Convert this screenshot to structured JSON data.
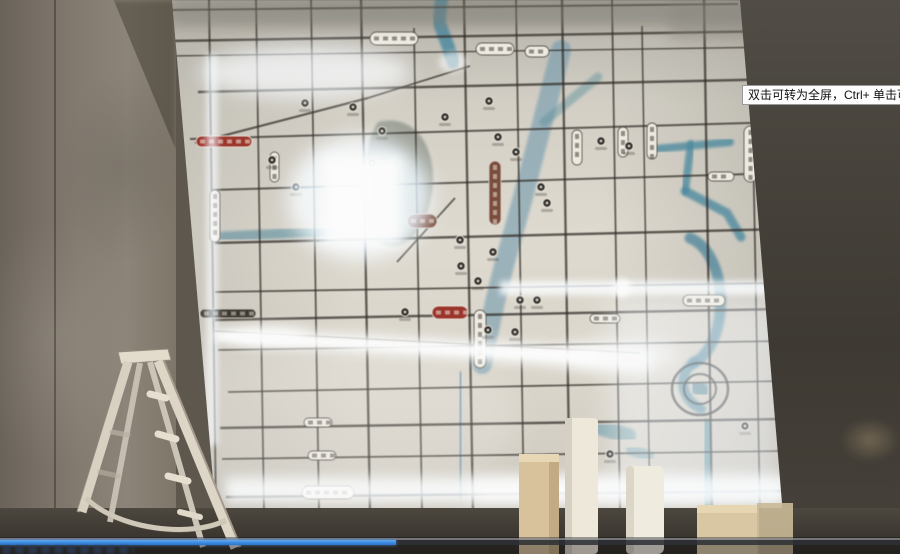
{
  "player": {
    "tooltip": "双击可转为全屏，Ctrl+ 单击可转为",
    "progress_percent": 44,
    "colors": {
      "progress": "#3f8fe6",
      "track": "#2e3036"
    }
  },
  "map": {
    "colors": {
      "road": "#2f2a24"
    },
    "label_styles": {
      "w": {
        "f": "#efece3",
        "s": "rgba(62,56,47,0.8)",
        "t": "#443e34"
      },
      "r": {
        "f": "#a33228",
        "s": "#e9e1d3",
        "t": "#f5ece0"
      },
      "rb": {
        "f": "#7d4a38",
        "s": "#d8d0c2",
        "t": "#efe5d8"
      },
      "d": {
        "f": "#3c372f",
        "s": "#cfc8ba",
        "t": "#d6cfc0"
      }
    },
    "roads": [
      [
        0,
        10,
        568,
        4,
        2
      ],
      [
        0,
        41,
        610,
        31,
        2.5
      ],
      [
        0,
        56,
        610,
        47,
        1.5
      ],
      [
        28,
        92,
        613,
        79,
        2.5
      ],
      [
        20,
        139,
        613,
        122,
        2
      ],
      [
        42,
        190,
        613,
        173,
        2
      ],
      [
        45,
        243,
        613,
        229,
        2.5
      ],
      [
        45,
        292,
        613,
        283,
        1.8
      ],
      [
        45,
        320,
        613,
        309,
        2.5
      ],
      [
        48,
        350,
        613,
        341,
        1.8
      ],
      [
        58,
        392,
        613,
        381,
        1.8
      ],
      [
        50,
        428,
        613,
        419,
        2.5
      ],
      [
        52,
        459,
        613,
        451,
        1.8
      ],
      [
        56,
        497,
        613,
        491,
        2.5
      ],
      [
        39,
        0,
        46,
        512,
        2
      ],
      [
        86,
        0,
        94,
        512,
        1.8
      ],
      [
        141,
        0,
        149,
        512,
        1.8
      ],
      [
        191,
        0,
        200,
        512,
        2.4
      ],
      [
        244,
        28,
        252,
        512,
        1.8
      ],
      [
        294,
        0,
        303,
        512,
        2.4
      ],
      [
        346,
        0,
        354,
        512,
        1.8
      ],
      [
        392,
        0,
        400,
        512,
        2.4
      ],
      [
        442,
        0,
        450,
        512,
        1.8
      ],
      [
        472,
        26,
        480,
        512,
        1.6
      ],
      [
        534,
        0,
        542,
        512,
        2.4
      ],
      [
        582,
        88,
        590,
        512,
        1.8
      ],
      [
        25,
        143,
        198,
        98,
        2.2
      ],
      [
        198,
        98,
        300,
        66,
        1.8
      ],
      [
        227,
        262,
        285,
        198,
        1.8
      ],
      [
        45,
        331,
        470,
        353,
        1.2
      ]
    ],
    "rivers": [
      {
        "d": "M272,-5 L269,22 L278,46 L283,62",
        "w": 13,
        "c": "#4a8ba3",
        "o": 0.85
      },
      {
        "d": "M391,50 C374,115 352,205 336,258 C327,292 318,332 312,364",
        "w": 20,
        "c": "#6e9ab0",
        "o": 0.6
      },
      {
        "d": "M291,378 L290,492",
        "w": 13,
        "c": "#5d93ab",
        "o": 0.7
      },
      {
        "d": "M486,149 L560,142",
        "w": 8,
        "c": "#4a8ba3",
        "o": 0.8
      },
      {
        "d": "M521,144 L515,191",
        "w": 8,
        "c": "#4a8ba3",
        "o": 0.8
      },
      {
        "d": "M515,191 L557,213 L571,237",
        "w": 9,
        "c": "#4a8ba3",
        "o": 0.8
      },
      {
        "d": "M520,238 C559,254 561,342 524,363",
        "w": 11,
        "c": "#4f89a0",
        "o": 0.8
      },
      {
        "d": "M524,362 C506,376 512,400 531,409",
        "w": 10,
        "c": "#4f89a0",
        "o": 0.8
      },
      {
        "d": "M536,425 L539,508",
        "w": 12,
        "c": "#4e8ea0",
        "o": 0.75
      },
      {
        "d": "M45,237 L162,231",
        "w": 10,
        "c": "#5f93a4",
        "o": 0.65
      },
      {
        "d": "M428,77 L374,122",
        "w": 9,
        "c": "#57909f",
        "o": 0.45
      },
      {
        "d": "M432,428 L458,436",
        "w": 16,
        "c": "#4e8ea0",
        "o": 0.55
      },
      {
        "d": "M462,450 L478,456",
        "w": 12,
        "c": "#4e8ea0",
        "o": 0.5
      },
      {
        "d": "M408,460 L422,466",
        "w": 9,
        "c": "#4e8ea0",
        "o": 0.45
      },
      {
        "d": "M208,122 C248,112 268,152 262,192 C257,228 236,254 212,244 C192,234 188,152 208,122",
        "w": 0,
        "c": "#5c6b60",
        "o": 0.45
      },
      {
        "d": "M526,386 L534,392",
        "w": 15,
        "c": "#3f7a92",
        "o": 0.7
      }
    ],
    "pois": [
      [
        135,
        103
      ],
      [
        183,
        107
      ],
      [
        102,
        160
      ],
      [
        126,
        187
      ],
      [
        202,
        163
      ],
      [
        212,
        131
      ],
      [
        275,
        117
      ],
      [
        319,
        101
      ],
      [
        328,
        137
      ],
      [
        346,
        152
      ],
      [
        371,
        187
      ],
      [
        377,
        203
      ],
      [
        431,
        141
      ],
      [
        459,
        146
      ],
      [
        291,
        266
      ],
      [
        308,
        281
      ],
      [
        323,
        252
      ],
      [
        350,
        300
      ],
      [
        367,
        300
      ],
      [
        235,
        312
      ],
      [
        290,
        240
      ],
      [
        318,
        330
      ],
      [
        345,
        332
      ],
      [
        440,
        454
      ],
      [
        575,
        426
      ]
    ],
    "labels": [
      {
        "x": 200,
        "y": 32,
        "w": 48,
        "h": 13,
        "v": 0,
        "c": "w"
      },
      {
        "x": 306,
        "y": 43,
        "w": 38,
        "h": 12,
        "v": 0,
        "c": "w"
      },
      {
        "x": 355,
        "y": 46,
        "w": 24,
        "h": 11,
        "v": 0,
        "c": "w"
      },
      {
        "x": 26,
        "y": 136,
        "w": 56,
        "h": 11,
        "v": 0,
        "c": "r"
      },
      {
        "x": 30,
        "y": 309,
        "w": 56,
        "h": 9,
        "v": 0,
        "c": "d"
      },
      {
        "x": 262,
        "y": 306,
        "w": 36,
        "h": 13,
        "v": 0,
        "c": "r"
      },
      {
        "x": 237,
        "y": 214,
        "w": 30,
        "h": 14,
        "v": 0,
        "c": "rb"
      },
      {
        "x": 132,
        "y": 486,
        "w": 52,
        "h": 13,
        "v": 0,
        "c": "w"
      },
      {
        "x": 134,
        "y": 418,
        "w": 28,
        "h": 9,
        "v": 0,
        "c": "w"
      },
      {
        "x": 138,
        "y": 451,
        "w": 28,
        "h": 9,
        "v": 0,
        "c": "w"
      },
      {
        "x": 513,
        "y": 295,
        "w": 42,
        "h": 11,
        "v": 0,
        "c": "w"
      },
      {
        "x": 420,
        "y": 314,
        "w": 30,
        "h": 9,
        "v": 0,
        "c": "w"
      },
      {
        "x": 538,
        "y": 172,
        "w": 26,
        "h": 9,
        "v": 0,
        "c": "w"
      },
      {
        "x": 40,
        "y": 190,
        "w": 10,
        "h": 52,
        "v": 1,
        "c": "w"
      },
      {
        "x": 100,
        "y": 152,
        "w": 9,
        "h": 30,
        "v": 1,
        "c": "w"
      },
      {
        "x": 193,
        "y": 164,
        "w": 10,
        "h": 38,
        "v": 1,
        "c": "w"
      },
      {
        "x": 304,
        "y": 310,
        "w": 12,
        "h": 58,
        "v": 1,
        "c": "w"
      },
      {
        "x": 402,
        "y": 130,
        "w": 10,
        "h": 35,
        "v": 1,
        "c": "w"
      },
      {
        "x": 448,
        "y": 127,
        "w": 10,
        "h": 30,
        "v": 1,
        "c": "w"
      },
      {
        "x": 477,
        "y": 123,
        "w": 10,
        "h": 36,
        "v": 1,
        "c": "w"
      },
      {
        "x": 574,
        "y": 126,
        "w": 13,
        "h": 56,
        "v": 1,
        "c": "w"
      },
      {
        "x": 319,
        "y": 161,
        "w": 12,
        "h": 64,
        "v": 1,
        "c": "rb"
      }
    ]
  }
}
